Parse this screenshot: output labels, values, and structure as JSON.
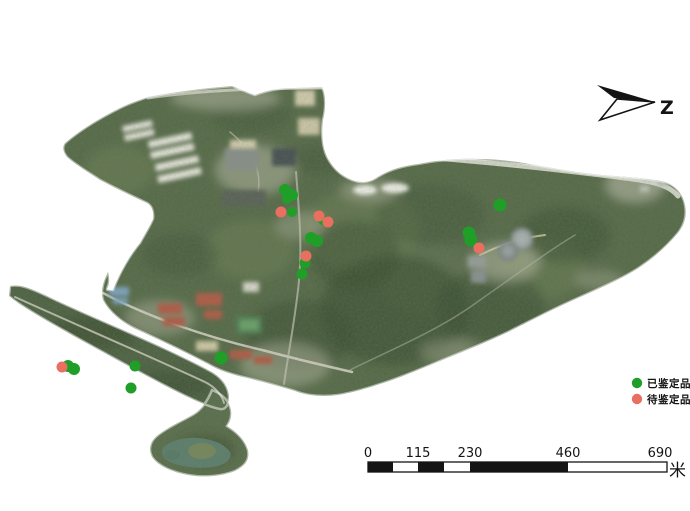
{
  "north_arrow": {
    "label": "Z"
  },
  "legend": {
    "items": [
      {
        "id": "identified",
        "label": "已鉴定品种",
        "color": "#1f9f27"
      },
      {
        "id": "pending",
        "label": "待鉴定品种",
        "color": "#e96f61"
      }
    ]
  },
  "scale_bar": {
    "tick_labels": [
      "0",
      "115",
      "230",
      "460",
      "690"
    ],
    "unit_label": "米"
  },
  "map": {
    "marker_colors": {
      "identified": "#1f9f27",
      "pending": "#e96f61"
    },
    "points": {
      "identified": [
        [
          285,
          190,
          6
        ],
        [
          292,
          195,
          6
        ],
        [
          287,
          199,
          5
        ],
        [
          292,
          212,
          5
        ],
        [
          323,
          220,
          5
        ],
        [
          311,
          238,
          6
        ],
        [
          317,
          241,
          6
        ],
        [
          305,
          263,
          5.5
        ],
        [
          302,
          274,
          5.5
        ],
        [
          500,
          205,
          6.5
        ],
        [
          469,
          233,
          6.5
        ],
        [
          471,
          240,
          6.5
        ],
        [
          68,
          366,
          6
        ],
        [
          74,
          369,
          6
        ],
        [
          135,
          366,
          5.5
        ],
        [
          131,
          388,
          5.5
        ],
        [
          221,
          358,
          6.5
        ]
      ],
      "pending": [
        [
          281,
          212,
          5.5
        ],
        [
          319,
          216,
          5.5
        ],
        [
          328,
          222,
          5.5
        ],
        [
          306,
          256,
          5.5
        ],
        [
          479,
          248,
          5.5
        ],
        [
          62,
          367,
          5.5
        ]
      ]
    }
  }
}
